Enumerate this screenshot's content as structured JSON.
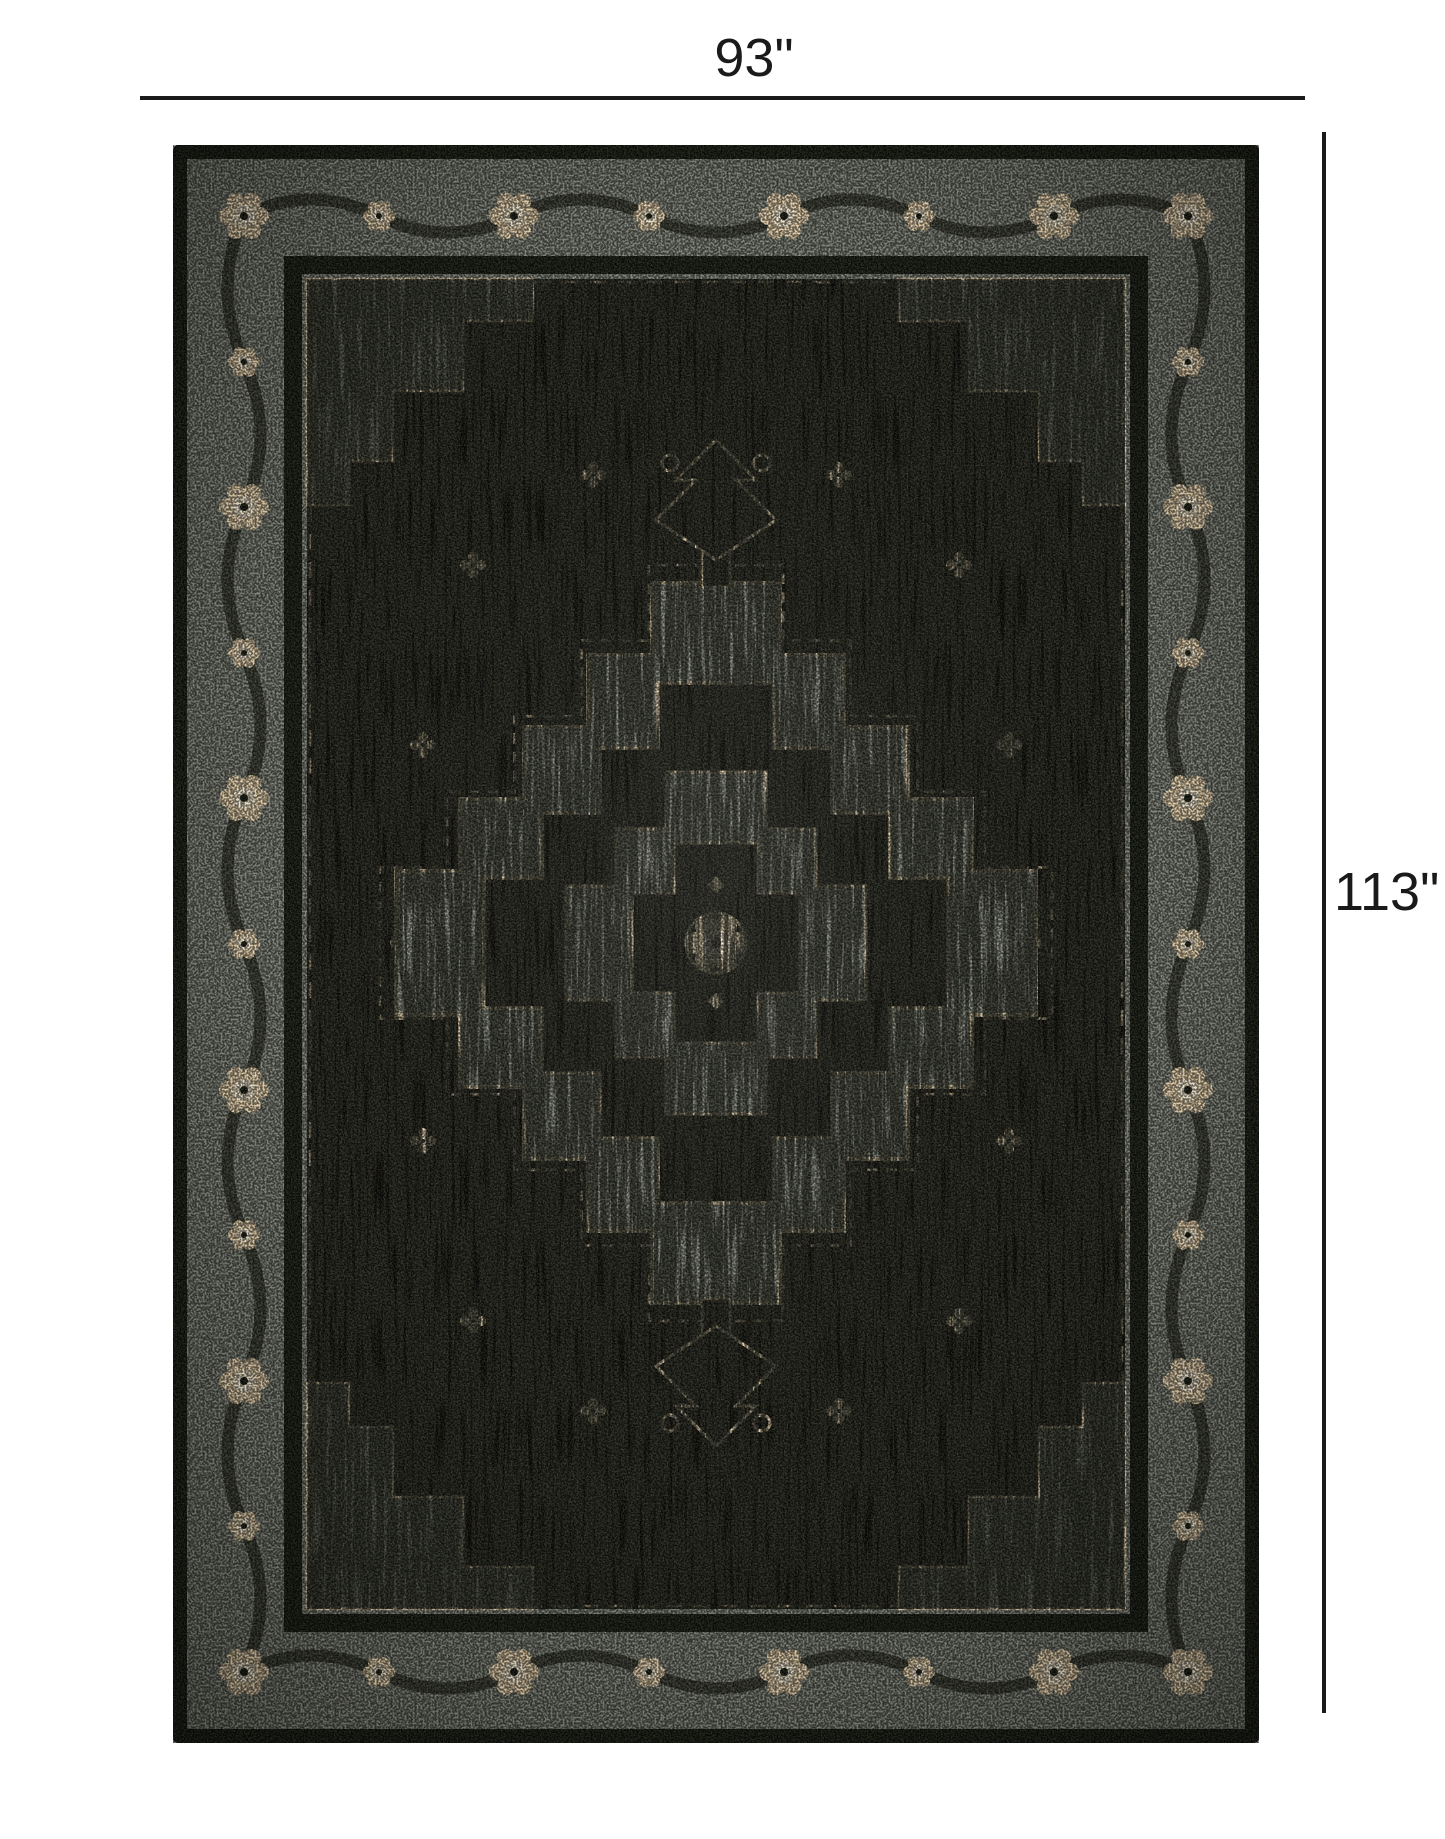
{
  "figure": {
    "width_label": "93\"",
    "height_label": "113\"",
    "description": "Distressed black and gray oriental medallion area rug shown with width and height dimension lines"
  },
  "palette": {
    "page-bg": "#ffffff",
    "dim-ink": "#1a1a1a",
    "rug-edge": "#141a12",
    "border-gray": "#7d837a",
    "border-gray-light": "#9ba29a",
    "border-dark": "#23271f",
    "cream": "#e8d4b0",
    "cream-light": "#f4ead2",
    "field-black": "#0b0c09",
    "field-streak": "#262a22",
    "medallion-gray": "#8a9086",
    "spandrel-gray": "#565c53"
  }
}
